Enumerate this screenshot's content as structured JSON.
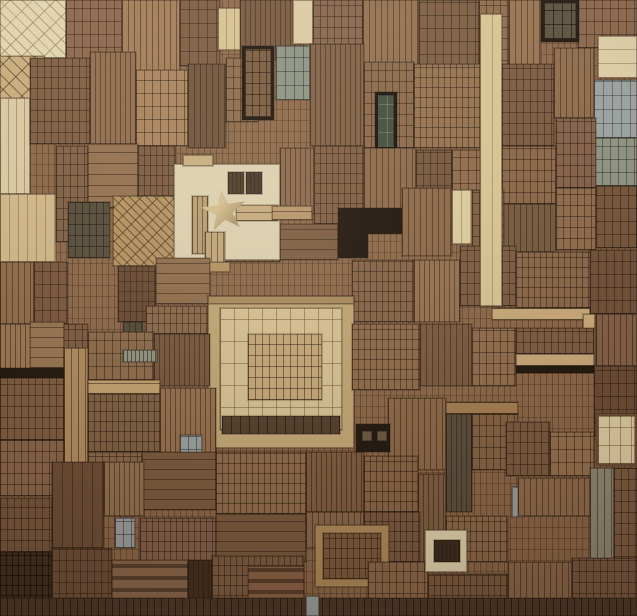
{
  "scene": {
    "subject": "Wall artwork: dense collage of antique letterpress wood printing blocks with a cream relief-star panel",
    "canvas": {
      "width": 637,
      "height": 616,
      "background": "#8b6749"
    }
  },
  "palette": {
    "base_brown": "#8b6749",
    "mid_brown": "#93704e",
    "dark_brown": "#6a4a33",
    "deep_brown": "#4e3826",
    "red_brown": "#84543a",
    "light_tan": "#c2a274",
    "cream": "#ddd0b0",
    "pale_strip": "#d8c391",
    "near_black": "#1d140d",
    "gray_green": "#8e927f",
    "gray_blue": "#9aa1a0",
    "dark_green": "#3f4c3a"
  },
  "star": {
    "x": 201,
    "y": 189,
    "width": 46,
    "height": 44,
    "rotation": -8,
    "fill_light": "#d3bd8e",
    "fill_dark": "#ac9468"
  },
  "block_format": [
    "x",
    "y",
    "w",
    "h",
    "fill",
    "texture",
    "spacing",
    "line_color(optional)",
    "border(optional)"
  ],
  "texture_legend": {
    "g": "grid",
    "v": "vertical-lines",
    "h": "horizontal-lines",
    "d": "diagonal-lattice",
    "b": "thick-horizontal-bars",
    "s": "solid"
  },
  "blocks": [
    [
      0,
      0,
      66,
      58,
      "#e2d3ad",
      "d",
      8,
      "rgba(150,115,70,.6)"
    ],
    [
      0,
      56,
      44,
      44,
      "#c9ab79",
      "d",
      9
    ],
    [
      66,
      0,
      56,
      74,
      "#8a654a",
      "g",
      8
    ],
    [
      122,
      0,
      58,
      72,
      "#a17a53",
      "v",
      6
    ],
    [
      180,
      0,
      40,
      66,
      "#7c5a3f",
      "g",
      9
    ],
    [
      218,
      8,
      24,
      42,
      "#d7c190",
      "v",
      8,
      "rgba(130,100,60,.5)"
    ],
    [
      240,
      0,
      64,
      60,
      "#76563c",
      "v",
      5
    ],
    [
      293,
      0,
      20,
      44,
      "#dbc89f",
      "s",
      0
    ],
    [
      313,
      0,
      50,
      72,
      "#856248",
      "g",
      7
    ],
    [
      363,
      0,
      56,
      66,
      "#926e4c",
      "v",
      6
    ],
    [
      419,
      0,
      60,
      68,
      "#7c5b40",
      "g",
      8
    ],
    [
      479,
      0,
      30,
      72,
      "#8d6a49",
      "g",
      7
    ],
    [
      509,
      0,
      32,
      66,
      "#97724e",
      "v",
      6
    ],
    [
      578,
      0,
      59,
      48,
      "#8a6549",
      "g",
      8
    ],
    [
      541,
      0,
      38,
      42,
      "#584f3e",
      "g",
      9,
      "rgba(20,14,8,.7)",
      "3px solid #1d150d"
    ],
    [
      598,
      36,
      39,
      42,
      "#dfcea5",
      "h",
      9,
      "rgba(140,105,60,.5)"
    ],
    [
      594,
      80,
      43,
      58,
      "#9aa1a0",
      "g",
      9,
      "rgba(50,50,45,.45)"
    ],
    [
      594,
      138,
      43,
      48,
      "#8e927f",
      "g",
      8,
      "rgba(45,45,35,.5)"
    ],
    [
      0,
      98,
      30,
      96,
      "#dac7a0",
      "v",
      8,
      "rgba(130,100,60,.5)"
    ],
    [
      30,
      58,
      60,
      86,
      "#7e5d41",
      "g",
      7
    ],
    [
      90,
      52,
      46,
      92,
      "#8f6b4a",
      "v",
      5
    ],
    [
      136,
      70,
      52,
      76,
      "#a8815a",
      "g",
      8
    ],
    [
      188,
      64,
      38,
      84,
      "#6f5038",
      "v",
      6
    ],
    [
      226,
      58,
      32,
      64,
      "#8d6a4a",
      "g",
      7
    ],
    [
      276,
      46,
      34,
      54,
      "#8a9182",
      "g",
      9,
      "rgba(40,42,35,.5)"
    ],
    [
      310,
      44,
      54,
      102,
      "#7f5e42",
      "v",
      5
    ],
    [
      364,
      62,
      50,
      86,
      "#8a6749",
      "g",
      7
    ],
    [
      414,
      64,
      66,
      84,
      "#94704d",
      "g",
      6
    ],
    [
      502,
      64,
      52,
      82,
      "#7b5a3f",
      "g",
      7
    ],
    [
      554,
      48,
      40,
      70,
      "#8f6c4b",
      "v",
      6
    ],
    [
      242,
      46,
      32,
      74,
      "#7a5a3e",
      "g",
      7,
      "rgba(30,18,8,.6)",
      "3px solid #1b120b"
    ],
    [
      375,
      92,
      22,
      58,
      "#3f4c3a",
      "g",
      9,
      "rgba(160,170,140,.35)",
      "3px solid #161009"
    ],
    [
      0,
      194,
      56,
      68,
      "#cfb687",
      "v",
      9,
      "rgba(130,95,55,.5)"
    ],
    [
      56,
      146,
      32,
      96,
      "#826044",
      "g",
      7
    ],
    [
      88,
      144,
      50,
      64,
      "#93704e",
      "h",
      7
    ],
    [
      138,
      146,
      38,
      60,
      "#7b5a40",
      "g",
      6
    ],
    [
      280,
      148,
      34,
      66,
      "#8a664a",
      "v",
      5
    ],
    [
      314,
      146,
      50,
      78,
      "#7f5c41",
      "g",
      6
    ],
    [
      364,
      148,
      52,
      62,
      "#8c6849",
      "v",
      6
    ],
    [
      416,
      150,
      36,
      58,
      "#77573d",
      "g",
      7
    ],
    [
      452,
      150,
      44,
      60,
      "#8f6b4a",
      "g",
      8
    ],
    [
      502,
      146,
      54,
      58,
      "#8b6748",
      "g",
      7
    ],
    [
      502,
      204,
      54,
      48,
      "#775a3f",
      "v",
      6
    ],
    [
      556,
      118,
      40,
      70,
      "#84614a",
      "g",
      7
    ],
    [
      556,
      188,
      40,
      62,
      "#8f6b4b",
      "g",
      7
    ],
    [
      596,
      186,
      41,
      62,
      "#77573d",
      "g",
      8
    ],
    [
      68,
      202,
      42,
      56,
      "#554c39",
      "g",
      7,
      "rgba(25,22,14,.55)"
    ],
    [
      113,
      196,
      62,
      70,
      "#b5915f",
      "d",
      6
    ],
    [
      216,
      224,
      64,
      38,
      "#8d6a4b",
      "g",
      7
    ],
    [
      280,
      224,
      58,
      36,
      "#7c5b40",
      "h",
      6
    ],
    [
      174,
      164,
      106,
      96,
      "#ddd0b0",
      "s",
      0
    ],
    [
      183,
      155,
      30,
      11,
      "#c6ad7e",
      "s",
      0
    ],
    [
      228,
      172,
      16,
      22,
      "#4b3b29",
      "v",
      4
    ],
    [
      246,
      172,
      16,
      22,
      "#453529",
      "v",
      4
    ],
    [
      192,
      196,
      16,
      58,
      "#b99b6e",
      "v",
      5
    ],
    [
      236,
      205,
      42,
      16,
      "#c5a97a",
      "h",
      5
    ],
    [
      272,
      206,
      40,
      14,
      "#b69468",
      "h",
      5
    ],
    [
      205,
      232,
      20,
      34,
      "#c2a577",
      "v",
      6
    ],
    [
      202,
      262,
      28,
      10,
      "#b29160",
      "s",
      0
    ],
    [
      338,
      208,
      64,
      26,
      "#1d140d",
      "s",
      0
    ],
    [
      338,
      234,
      30,
      24,
      "#1d140d",
      "s",
      0
    ],
    [
      402,
      188,
      50,
      68,
      "#8c6849",
      "v",
      6
    ],
    [
      452,
      190,
      20,
      54,
      "#ddca9c",
      "v",
      9,
      "rgba(140,110,65,.5)"
    ],
    [
      472,
      190,
      32,
      58,
      "#7f5e42",
      "g",
      7
    ],
    [
      0,
      262,
      34,
      62,
      "#8f6b4b",
      "v",
      6
    ],
    [
      34,
      262,
      34,
      62,
      "#7a573d",
      "g",
      8
    ],
    [
      118,
      266,
      38,
      56,
      "#6a4a33",
      "g",
      6
    ],
    [
      156,
      258,
      54,
      46,
      "#8f6c4a",
      "h",
      6
    ],
    [
      146,
      306,
      62,
      28,
      "#8a6749",
      "g",
      6
    ],
    [
      0,
      324,
      40,
      72,
      "#9a7550",
      "v",
      5
    ],
    [
      40,
      324,
      48,
      72,
      "#7d5b3f",
      "g",
      7
    ],
    [
      352,
      260,
      62,
      62,
      "#866346",
      "g",
      6
    ],
    [
      414,
      260,
      46,
      62,
      "#94714e",
      "v",
      5
    ],
    [
      460,
      246,
      56,
      60,
      "#7d5c41",
      "g",
      7
    ],
    [
      516,
      252,
      76,
      56,
      "#8a6749",
      "g",
      6
    ],
    [
      590,
      250,
      47,
      64,
      "#72523a",
      "g",
      8
    ],
    [
      480,
      14,
      22,
      292,
      "#d8c391",
      "v",
      12,
      "rgba(135,105,60,.5)"
    ],
    [
      492,
      308,
      98,
      12,
      "#c9a977",
      "h",
      7
    ],
    [
      583,
      314,
      12,
      50,
      "#c9a977",
      "s",
      0
    ],
    [
      596,
      314,
      41,
      52,
      "#846146",
      "v",
      6
    ],
    [
      208,
      296,
      146,
      152,
      "#c2a673",
      "s",
      0
    ],
    [
      208,
      296,
      146,
      8,
      "#a98a5c",
      "s",
      0
    ],
    [
      220,
      308,
      122,
      122,
      "#d8c292",
      "g",
      14,
      "rgba(122,90,56,.55)"
    ],
    [
      248,
      334,
      74,
      66,
      "#c7a977",
      "g",
      7
    ],
    [
      222,
      416,
      118,
      18,
      "#54402b",
      "v",
      9,
      "rgba(20,12,6,.6)"
    ],
    [
      0,
      368,
      64,
      10,
      "#241a10",
      "s",
      0
    ],
    [
      30,
      322,
      34,
      46,
      "#97744f",
      "h",
      6
    ],
    [
      123,
      322,
      20,
      44,
      "#4f4a38",
      "v",
      6
    ],
    [
      88,
      332,
      66,
      48,
      "#8d6a49",
      "g",
      8
    ],
    [
      154,
      334,
      56,
      52,
      "#77563c",
      "v",
      5
    ],
    [
      123,
      350,
      34,
      12,
      "#8f927e",
      "v",
      4,
      "rgba(35,35,28,.6)"
    ],
    [
      352,
      324,
      68,
      66,
      "#8f6b4a",
      "g",
      6
    ],
    [
      420,
      324,
      52,
      62,
      "#7b5a3f",
      "v",
      6
    ],
    [
      472,
      328,
      44,
      58,
      "#916d4b",
      "g",
      7
    ],
    [
      516,
      328,
      78,
      26,
      "#7e5d41",
      "g",
      7
    ],
    [
      516,
      354,
      78,
      12,
      "#c9a878",
      "h",
      8
    ],
    [
      516,
      366,
      78,
      7,
      "#241a10",
      "s",
      0
    ],
    [
      594,
      366,
      43,
      70,
      "#6d4d36",
      "g",
      8
    ],
    [
      0,
      378,
      64,
      62,
      "#7e5c40",
      "g",
      7
    ],
    [
      64,
      348,
      24,
      268,
      "#b08a5c",
      "v",
      7
    ],
    [
      88,
      380,
      72,
      14,
      "#c2a06c",
      "h",
      6
    ],
    [
      88,
      394,
      72,
      58,
      "#806043",
      "g",
      6
    ],
    [
      160,
      388,
      56,
      68,
      "#946f4c",
      "v",
      5
    ],
    [
      388,
      398,
      58,
      72,
      "#8c6848",
      "v",
      6
    ],
    [
      446,
      402,
      72,
      12,
      "#a57e52",
      "h",
      7
    ],
    [
      446,
      414,
      26,
      98,
      "#5a4f3c",
      "v",
      5
    ],
    [
      472,
      414,
      46,
      56,
      "#866344",
      "g",
      7
    ],
    [
      506,
      422,
      44,
      54,
      "#7c5a3f",
      "g",
      7
    ],
    [
      550,
      432,
      44,
      44,
      "#95714e",
      "g",
      8
    ],
    [
      596,
      414,
      41,
      52,
      "#e0cda1",
      "g",
      11,
      "rgba(120,90,50,.55)",
      "2px solid #6b4c32"
    ],
    [
      590,
      468,
      24,
      100,
      "#8f8873",
      "v",
      7
    ],
    [
      614,
      468,
      23,
      100,
      "#7d5c40",
      "g",
      7
    ],
    [
      356,
      424,
      34,
      28,
      "#241a12",
      "s",
      0
    ],
    [
      362,
      431,
      10,
      10,
      "#6b5a42",
      "s",
      0
    ],
    [
      377,
      431,
      10,
      10,
      "#6b5a42",
      "s",
      0
    ],
    [
      418,
      474,
      28,
      88,
      "#7f5e42",
      "v",
      5
    ],
    [
      180,
      435,
      22,
      28,
      "#98a09f",
      "g",
      8,
      "rgba(40,42,40,.5)"
    ],
    [
      0,
      440,
      64,
      56,
      "#8a664a",
      "g",
      7
    ],
    [
      88,
      452,
      54,
      60,
      "#8a6748",
      "g",
      7
    ],
    [
      142,
      452,
      74,
      58,
      "#7b5a3e",
      "h",
      6
    ],
    [
      216,
      452,
      90,
      62,
      "#8f6b4a",
      "g",
      6
    ],
    [
      306,
      452,
      58,
      60,
      "#7f5c3f",
      "v",
      5
    ],
    [
      364,
      456,
      54,
      56,
      "#8a6546",
      "g",
      6
    ],
    [
      52,
      462,
      52,
      86,
      "#6e4e35",
      "v",
      10
    ],
    [
      104,
      462,
      40,
      54,
      "#93704e",
      "v",
      5
    ],
    [
      115,
      518,
      20,
      30,
      "#9aa0a0",
      "g",
      8,
      "rgba(40,42,42,.5)"
    ],
    [
      446,
      516,
      62,
      46,
      "#8d6949",
      "g",
      6
    ],
    [
      512,
      487,
      12,
      30,
      "#9aa19f",
      "s",
      0
    ],
    [
      518,
      478,
      72,
      38,
      "#8f6b4a",
      "v",
      6
    ],
    [
      0,
      498,
      52,
      54,
      "#77563c",
      "g",
      7
    ],
    [
      140,
      518,
      76,
      44,
      "#84614a",
      "g",
      6
    ],
    [
      216,
      514,
      90,
      48,
      "#7a593d",
      "h",
      6
    ],
    [
      306,
      512,
      58,
      36,
      "#8a6749",
      "v",
      6
    ],
    [
      364,
      512,
      56,
      50,
      "#7b5940",
      "g",
      6
    ],
    [
      0,
      552,
      52,
      64,
      "#3f2d1e",
      "g",
      6,
      "rgba(10,6,3,.6)"
    ],
    [
      52,
      548,
      60,
      68,
      "#6f4f37",
      "g",
      7
    ],
    [
      112,
      560,
      76,
      56,
      "#8a6649",
      "b",
      12
    ],
    [
      188,
      560,
      24,
      56,
      "#442f1e",
      "v",
      5
    ],
    [
      212,
      556,
      92,
      60,
      "#7d5c41",
      "g",
      6
    ],
    [
      315,
      525,
      74,
      62,
      "#b08a58",
      "s",
      0
    ],
    [
      323,
      533,
      58,
      46,
      "#7d5a3d",
      "g",
      6
    ],
    [
      248,
      566,
      56,
      50,
      "#8a6245",
      "b",
      11
    ],
    [
      368,
      562,
      60,
      54,
      "#8d6949",
      "g",
      7
    ],
    [
      428,
      574,
      80,
      42,
      "#7a593e",
      "g",
      6
    ],
    [
      425,
      530,
      42,
      42,
      "#e2d2ac",
      "s",
      0
    ],
    [
      434,
      540,
      26,
      22,
      "#3a2c1e",
      "v",
      4
    ],
    [
      508,
      562,
      64,
      54,
      "#8a6749",
      "v",
      6
    ],
    [
      572,
      558,
      65,
      58,
      "#795840",
      "g",
      7
    ],
    [
      0,
      598,
      637,
      18,
      "#4e3826",
      "v",
      7,
      "rgba(15,8,4,.6)"
    ],
    [
      306,
      596,
      13,
      20,
      "#9aa1a0",
      "s",
      0
    ]
  ]
}
